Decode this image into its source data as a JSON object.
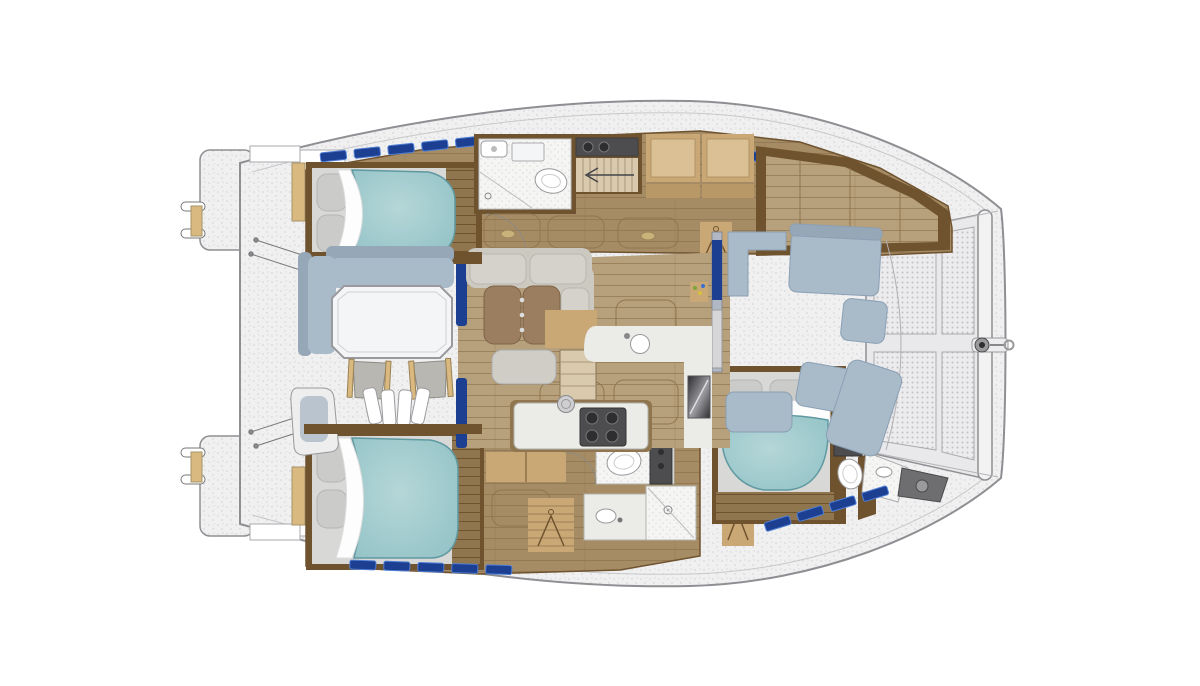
{
  "image": {
    "kind": "yacht-floor-plan",
    "subject": "catamaran-interior-top-view",
    "orientation": "bow-right-stern-left"
  },
  "areas": [
    "stern-transom-platforms",
    "aft-cockpit-dining",
    "salon-lounge",
    "galley",
    "port-hull-aft-cabin",
    "port-hull-head",
    "port-hull-companionway",
    "port-hull-forward-berth",
    "starboard-hull-aft-cabin",
    "starboard-hull-heads",
    "starboard-hull-forward-cabin",
    "forward-cockpit",
    "bow-trampoline"
  ],
  "inventory": {
    "double_berths": 3,
    "toilets": 3,
    "showers": 3,
    "dining_tables": 2,
    "deck_chairs": 2,
    "trampoline_panels": 4
  },
  "colors": {
    "page_bg": "#ffffff",
    "deck": "#f0f0f1",
    "deck_speckle": "#d9d9db",
    "hull_stroke": "#8f8f93",
    "rail_line": "#c8c8cb",
    "wood_floor": "#a58c64",
    "wood_floor_light": "#b7a07c",
    "wood_floor_dark": "#8f764f",
    "wood_line": "#937a55",
    "wood_trim": "#6f532f",
    "wood_trim_dark": "#5a4226",
    "cabinet": "#c9a876",
    "cabinet_light": "#dcc095",
    "shelf": "#b99868",
    "tan_wood": "#d9b97f",
    "bed_teal": "#8fc0c4",
    "bed_teal_light": "#b5d7d8",
    "bed_teal_edge": "#5f99a1",
    "mattress": "#d8d8d6",
    "pillow": "#cbcbc9",
    "sheet_white": "#fdfdfd",
    "sofa": "#ccc9c1",
    "sofa_seat": "#d4d2ca",
    "sofa_edge": "#a7a59d",
    "ottoman": "#cfcdc5",
    "cushion_blue": "#a9bac9",
    "cushion_blue_back": "#96a7b8",
    "cushion_stroke": "#8aa0b4",
    "helm_cushion": "#b9c4cf",
    "table_white": "#f4f5f6",
    "table_brown": "#9b7d60",
    "chair_seat": "#b9b7b1",
    "counter": "#ebebe7",
    "counter_stroke": "#b2b2ad",
    "bath_floor": "#f5f5f4",
    "bath_dot": "#dddddf",
    "appliance_dark": "#4d4d50",
    "appliance_darker": "#2e2e30",
    "stair_wood": "#d9c9ad",
    "stair_line": "#a9977a",
    "window_blue": "#1d3f92",
    "window_blue_light": "#4f7fd6",
    "mesh_bg": "#ececee",
    "mesh_dot": "#c2c2c6",
    "metal": "#9a9a9d",
    "bottle_green": "#7aa53a",
    "bottle_yellow": "#d8c23a",
    "bottle_blue": "#3a6fd0",
    "white": "#ffffff"
  }
}
